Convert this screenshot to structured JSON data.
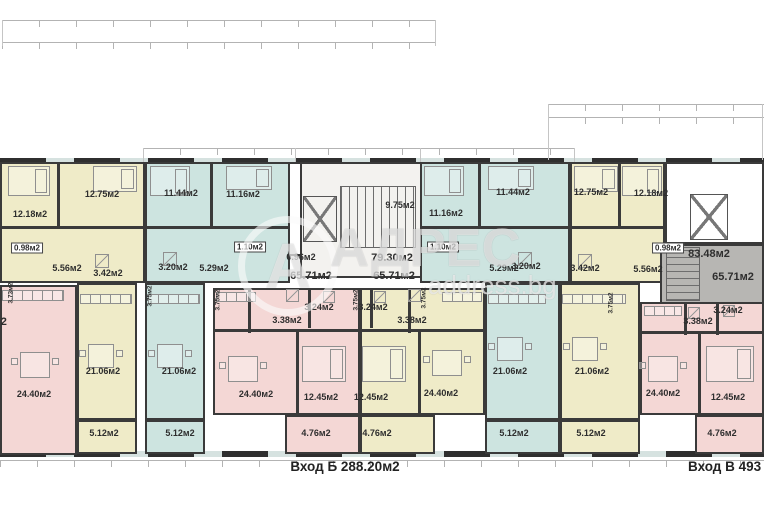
{
  "watermark": {
    "logo_letter": "А",
    "brand": "АДРЕС",
    "site": "address.bg"
  },
  "footer": {
    "entrance_b": "Вход Б 288.20м2",
    "entrance_v": "Вход В 493"
  },
  "colors": {
    "yellow": "#efebc8",
    "blue": "#cde4e0",
    "pink": "#f4d7d5",
    "gray": "#b7b6b3",
    "stair": "#f3f2ef",
    "wall": "#3a3a3a"
  },
  "regions": [
    {
      "name": "unit-yellow-left-top",
      "cls": "yellow",
      "x": 0,
      "y": 162,
      "w": 145,
      "h": 121
    },
    {
      "name": "unit-blue-left-top",
      "cls": "blue",
      "x": 145,
      "y": 162,
      "w": 145,
      "h": 121
    },
    {
      "name": "shaft-left",
      "cls": "white",
      "x": 288,
      "y": 162,
      "w": 24,
      "h": 94
    },
    {
      "name": "stairwell-center",
      "cls": "stair",
      "x": 300,
      "y": 162,
      "w": 172,
      "h": 116
    },
    {
      "name": "unit-blue-right-top",
      "cls": "blue",
      "x": 420,
      "y": 162,
      "w": 150,
      "h": 121
    },
    {
      "name": "unit-yellow-right-top",
      "cls": "yellow",
      "x": 570,
      "y": 162,
      "w": 95,
      "h": 121
    },
    {
      "name": "stair-upper-right",
      "cls": "white",
      "x": 665,
      "y": 162,
      "w": 99,
      "h": 82
    },
    {
      "name": "stairwell-gray-right",
      "cls": "gray",
      "x": 660,
      "y": 244,
      "w": 104,
      "h": 60
    },
    {
      "name": "unit-pink-left",
      "cls": "pink",
      "x": 0,
      "y": 285,
      "w": 77,
      "h": 170
    },
    {
      "name": "living-yellow-left",
      "cls": "yellow",
      "x": 77,
      "y": 283,
      "w": 60,
      "h": 137
    },
    {
      "name": "balcony-yellow-left",
      "cls": "yellow",
      "x": 77,
      "y": 420,
      "w": 60,
      "h": 34
    },
    {
      "name": "living-blue-left",
      "cls": "blue",
      "x": 145,
      "y": 283,
      "w": 60,
      "h": 137
    },
    {
      "name": "balcony-blue-left",
      "cls": "blue",
      "x": 145,
      "y": 420,
      "w": 60,
      "h": 34
    },
    {
      "name": "unit-pink-mid",
      "cls": "pink",
      "x": 213,
      "y": 288,
      "w": 147,
      "h": 127
    },
    {
      "name": "balcony-pink-mid",
      "cls": "pink",
      "x": 285,
      "y": 415,
      "w": 75,
      "h": 39
    },
    {
      "name": "unit-yellow-mid",
      "cls": "yellow",
      "x": 360,
      "y": 288,
      "w": 125,
      "h": 127
    },
    {
      "name": "balcony-yellow-mid",
      "cls": "yellow",
      "x": 360,
      "y": 415,
      "w": 75,
      "h": 39
    },
    {
      "name": "living-blue-right",
      "cls": "blue",
      "x": 485,
      "y": 283,
      "w": 75,
      "h": 137
    },
    {
      "name": "balcony-blue-right",
      "cls": "blue",
      "x": 485,
      "y": 420,
      "w": 75,
      "h": 34
    },
    {
      "name": "living-yellow-right",
      "cls": "yellow",
      "x": 560,
      "y": 283,
      "w": 80,
      "h": 137
    },
    {
      "name": "balcony-yellow-right",
      "cls": "yellow",
      "x": 560,
      "y": 420,
      "w": 80,
      "h": 34
    },
    {
      "name": "unit-pink-right",
      "cls": "pink",
      "x": 640,
      "y": 302,
      "w": 124,
      "h": 113
    },
    {
      "name": "balcony-pink-right",
      "cls": "pink",
      "x": 695,
      "y": 415,
      "w": 69,
      "h": 39
    }
  ],
  "walls": [
    [
      57,
      162,
      3,
      66
    ],
    [
      210,
      162,
      3,
      66
    ],
    [
      478,
      162,
      3,
      66
    ],
    [
      618,
      162,
      3,
      66
    ],
    [
      0,
      226,
      290,
      3
    ],
    [
      420,
      226,
      245,
      3
    ],
    [
      296,
      330,
      3,
      85
    ],
    [
      418,
      330,
      3,
      85
    ],
    [
      698,
      333,
      3,
      82
    ],
    [
      213,
      329,
      147,
      3
    ],
    [
      360,
      329,
      125,
      3
    ],
    [
      640,
      331,
      124,
      3
    ],
    [
      248,
      288,
      3,
      45
    ],
    [
      308,
      288,
      3,
      40
    ],
    [
      370,
      288,
      3,
      40
    ],
    [
      408,
      288,
      3,
      45
    ],
    [
      684,
      302,
      3,
      33
    ],
    [
      716,
      302,
      3,
      33
    ]
  ],
  "furniture": [
    {
      "t": "bed",
      "x": 8,
      "y": 166,
      "w": 42,
      "h": 30
    },
    {
      "t": "bed",
      "x": 93,
      "y": 166,
      "w": 44,
      "h": 26
    },
    {
      "t": "bed",
      "x": 150,
      "y": 166,
      "w": 40,
      "h": 30
    },
    {
      "t": "bed",
      "x": 226,
      "y": 166,
      "w": 46,
      "h": 24
    },
    {
      "t": "bed",
      "x": 424,
      "y": 166,
      "w": 40,
      "h": 30
    },
    {
      "t": "bed",
      "x": 488,
      "y": 166,
      "w": 46,
      "h": 24
    },
    {
      "t": "bed",
      "x": 574,
      "y": 166,
      "w": 44,
      "h": 26
    },
    {
      "t": "bed",
      "x": 622,
      "y": 166,
      "w": 40,
      "h": 30
    },
    {
      "t": "bed",
      "x": 302,
      "y": 346,
      "w": 44,
      "h": 36
    },
    {
      "t": "bed",
      "x": 362,
      "y": 346,
      "w": 44,
      "h": 36
    },
    {
      "t": "bed",
      "x": 706,
      "y": 346,
      "w": 48,
      "h": 36
    },
    {
      "t": "table",
      "x": 20,
      "y": 352,
      "w": 30,
      "h": 26
    },
    {
      "t": "table",
      "x": 88,
      "y": 344,
      "w": 26,
      "h": 24
    },
    {
      "t": "table",
      "x": 157,
      "y": 344,
      "w": 26,
      "h": 24
    },
    {
      "t": "table",
      "x": 228,
      "y": 356,
      "w": 30,
      "h": 26
    },
    {
      "t": "table",
      "x": 432,
      "y": 350,
      "w": 30,
      "h": 26
    },
    {
      "t": "table",
      "x": 497,
      "y": 337,
      "w": 26,
      "h": 24
    },
    {
      "t": "table",
      "x": 572,
      "y": 337,
      "w": 26,
      "h": 24
    },
    {
      "t": "table",
      "x": 648,
      "y": 356,
      "w": 30,
      "h": 26
    },
    {
      "t": "chair",
      "x": 11,
      "y": 358,
      "w": 7,
      "h": 7
    },
    {
      "t": "chair",
      "x": 52,
      "y": 358,
      "w": 7,
      "h": 7
    },
    {
      "t": "chair",
      "x": 79,
      "y": 350,
      "w": 7,
      "h": 7
    },
    {
      "t": "chair",
      "x": 116,
      "y": 350,
      "w": 7,
      "h": 7
    },
    {
      "t": "chair",
      "x": 148,
      "y": 350,
      "w": 7,
      "h": 7
    },
    {
      "t": "chair",
      "x": 185,
      "y": 350,
      "w": 7,
      "h": 7
    },
    {
      "t": "chair",
      "x": 219,
      "y": 362,
      "w": 7,
      "h": 7
    },
    {
      "t": "chair",
      "x": 260,
      "y": 362,
      "w": 7,
      "h": 7
    },
    {
      "t": "chair",
      "x": 423,
      "y": 356,
      "w": 7,
      "h": 7
    },
    {
      "t": "chair",
      "x": 464,
      "y": 356,
      "w": 7,
      "h": 7
    },
    {
      "t": "chair",
      "x": 488,
      "y": 343,
      "w": 7,
      "h": 7
    },
    {
      "t": "chair",
      "x": 525,
      "y": 343,
      "w": 7,
      "h": 7
    },
    {
      "t": "chair",
      "x": 563,
      "y": 343,
      "w": 7,
      "h": 7
    },
    {
      "t": "chair",
      "x": 600,
      "y": 343,
      "w": 7,
      "h": 7
    },
    {
      "t": "chair",
      "x": 639,
      "y": 362,
      "w": 7,
      "h": 7
    },
    {
      "t": "chair",
      "x": 680,
      "y": 362,
      "w": 7,
      "h": 7
    },
    {
      "t": "counter",
      "x": 2,
      "y": 290,
      "w": 62,
      "h": 11
    },
    {
      "t": "counter",
      "x": 80,
      "y": 294,
      "w": 52,
      "h": 10
    },
    {
      "t": "counter",
      "x": 148,
      "y": 294,
      "w": 52,
      "h": 10
    },
    {
      "t": "counter",
      "x": 216,
      "y": 292,
      "w": 40,
      "h": 10
    },
    {
      "t": "counter",
      "x": 442,
      "y": 292,
      "w": 40,
      "h": 10
    },
    {
      "t": "counter",
      "x": 488,
      "y": 294,
      "w": 58,
      "h": 10
    },
    {
      "t": "counter",
      "x": 562,
      "y": 294,
      "w": 64,
      "h": 10
    },
    {
      "t": "counter",
      "x": 644,
      "y": 306,
      "w": 38,
      "h": 10
    },
    {
      "t": "shower",
      "x": 95,
      "y": 254,
      "w": 14,
      "h": 14
    },
    {
      "t": "shower",
      "x": 163,
      "y": 252,
      "w": 14,
      "h": 14
    },
    {
      "t": "shower",
      "x": 286,
      "y": 289,
      "w": 13,
      "h": 13
    },
    {
      "t": "shower",
      "x": 323,
      "y": 291,
      "w": 12,
      "h": 12
    },
    {
      "t": "shower",
      "x": 374,
      "y": 291,
      "w": 12,
      "h": 12
    },
    {
      "t": "shower",
      "x": 408,
      "y": 289,
      "w": 13,
      "h": 13
    },
    {
      "t": "shower",
      "x": 518,
      "y": 252,
      "w": 14,
      "h": 14
    },
    {
      "t": "shower",
      "x": 578,
      "y": 254,
      "w": 14,
      "h": 14
    },
    {
      "t": "shower",
      "x": 688,
      "y": 307,
      "w": 12,
      "h": 12
    },
    {
      "t": "shower",
      "x": 723,
      "y": 305,
      "w": 12,
      "h": 12
    },
    {
      "t": "stairs",
      "x": 340,
      "y": 186,
      "w": 76,
      "h": 62
    },
    {
      "t": "stairsv",
      "x": 666,
      "y": 247,
      "w": 34,
      "h": 54
    },
    {
      "t": "elev",
      "x": 303,
      "y": 196,
      "w": 34,
      "h": 46
    },
    {
      "t": "elev",
      "x": 690,
      "y": 194,
      "w": 38,
      "h": 46
    }
  ],
  "labels": [
    {
      "t": "12.18м2",
      "x": 30,
      "y": 214,
      "k": ""
    },
    {
      "t": "12.75м2",
      "x": 102,
      "y": 194,
      "k": ""
    },
    {
      "t": "5.56м2",
      "x": 67,
      "y": 268,
      "k": ""
    },
    {
      "t": "3.42м2",
      "x": 108,
      "y": 273,
      "k": ""
    },
    {
      "t": "21.06м2",
      "x": 103,
      "y": 371,
      "k": ""
    },
    {
      "t": "5.12м2",
      "x": 104,
      "y": 433,
      "k": ""
    },
    {
      "t": "24.40м2",
      "x": 34,
      "y": 394,
      "k": ""
    },
    {
      "t": "11.44м2",
      "x": 181,
      "y": 193,
      "k": ""
    },
    {
      "t": "11.16м2",
      "x": 243,
      "y": 194,
      "k": ""
    },
    {
      "t": "3.20м2",
      "x": 173,
      "y": 267,
      "k": ""
    },
    {
      "t": "5.29м2",
      "x": 214,
      "y": 268,
      "k": ""
    },
    {
      "t": "21.06м2",
      "x": 179,
      "y": 371,
      "k": ""
    },
    {
      "t": "5.12м2",
      "x": 180,
      "y": 433,
      "k": ""
    },
    {
      "t": "3.38м2",
      "x": 287,
      "y": 320,
      "k": ""
    },
    {
      "t": "3.24м2",
      "x": 319,
      "y": 307,
      "k": ""
    },
    {
      "t": "24.40м2",
      "x": 256,
      "y": 394,
      "k": ""
    },
    {
      "t": "12.45м2",
      "x": 321,
      "y": 397,
      "k": ""
    },
    {
      "t": "4.76м2",
      "x": 316,
      "y": 433,
      "k": ""
    },
    {
      "t": "9.75м2",
      "x": 400,
      "y": 205,
      "k": ""
    },
    {
      "t": "0.96м2",
      "x": 301,
      "y": 257,
      "k": ""
    },
    {
      "t": "3.24м2",
      "x": 373,
      "y": 307,
      "k": ""
    },
    {
      "t": "3.38м2",
      "x": 412,
      "y": 320,
      "k": ""
    },
    {
      "t": "12.45м2",
      "x": 371,
      "y": 397,
      "k": ""
    },
    {
      "t": "24.40м2",
      "x": 441,
      "y": 393,
      "k": ""
    },
    {
      "t": "4.76м2",
      "x": 377,
      "y": 433,
      "k": ""
    },
    {
      "t": "11.16м2",
      "x": 446,
      "y": 213,
      "k": ""
    },
    {
      "t": "11.44м2",
      "x": 513,
      "y": 192,
      "k": ""
    },
    {
      "t": "5.29м2",
      "x": 504,
      "y": 268,
      "k": ""
    },
    {
      "t": "3.20м2",
      "x": 526,
      "y": 266,
      "k": ""
    },
    {
      "t": "21.06м2",
      "x": 510,
      "y": 371,
      "k": ""
    },
    {
      "t": "5.12м2",
      "x": 514,
      "y": 433,
      "k": ""
    },
    {
      "t": "12.75м2",
      "x": 591,
      "y": 192,
      "k": ""
    },
    {
      "t": "12.18м2",
      "x": 651,
      "y": 193,
      "k": ""
    },
    {
      "t": "3.42м2",
      "x": 585,
      "y": 268,
      "k": ""
    },
    {
      "t": "5.56м2",
      "x": 648,
      "y": 269,
      "k": ""
    },
    {
      "t": "21.06м2",
      "x": 592,
      "y": 371,
      "k": ""
    },
    {
      "t": "5.12м2",
      "x": 591,
      "y": 433,
      "k": ""
    },
    {
      "t": "3.38м2",
      "x": 698,
      "y": 321,
      "k": ""
    },
    {
      "t": "3.24м2",
      "x": 728,
      "y": 310,
      "k": ""
    },
    {
      "t": "24.40м2",
      "x": 663,
      "y": 393,
      "k": ""
    },
    {
      "t": "12.45м2",
      "x": 728,
      "y": 397,
      "k": ""
    },
    {
      "t": "4.76м2",
      "x": 722,
      "y": 433,
      "k": ""
    },
    {
      "t": "0.98м2",
      "x": 27,
      "y": 248,
      "k": "box"
    },
    {
      "t": "1.10м2",
      "x": 250,
      "y": 247,
      "k": "box"
    },
    {
      "t": "1.10м2",
      "x": 443,
      "y": 247,
      "k": "box"
    },
    {
      "t": "0.98м2",
      "x": 668,
      "y": 248,
      "k": "box"
    },
    {
      "t": "65.71м2",
      "x": 311,
      "y": 276,
      "k": "big"
    },
    {
      "t": "65.71м2",
      "x": 394,
      "y": 276,
      "k": "big"
    },
    {
      "t": "65.71м2",
      "x": 733,
      "y": 277,
      "k": "big"
    },
    {
      "t": "79.30м2",
      "x": 392,
      "y": 258,
      "k": "big"
    },
    {
      "t": "83.48м2",
      "x": 709,
      "y": 254,
      "k": "big"
    },
    {
      "t": "65.71м2",
      "x": -14,
      "y": 322,
      "k": "big"
    },
    {
      "t": "3.73м2",
      "x": 11,
      "y": 293,
      "k": "rot"
    },
    {
      "t": "3.75м2",
      "x": 150,
      "y": 296,
      "k": "rot"
    },
    {
      "t": "3.75м2",
      "x": 218,
      "y": 300,
      "k": "rot"
    },
    {
      "t": "3.75м2",
      "x": 356,
      "y": 300,
      "k": "rot"
    },
    {
      "t": "3.75м2",
      "x": 424,
      "y": 298,
      "k": "rot"
    },
    {
      "t": "3.75м2",
      "x": 611,
      "y": 303,
      "k": "rot"
    }
  ],
  "dims": {
    "h": [
      [
        2,
        20,
        434
      ],
      [
        2,
        42,
        434
      ],
      [
        548,
        104,
        216
      ],
      [
        548,
        117,
        216
      ],
      [
        143,
        148,
        432
      ],
      [
        0,
        460,
        764
      ]
    ],
    "v": [
      [
        2,
        20,
        26
      ],
      [
        435,
        20,
        26
      ],
      [
        548,
        104,
        56
      ],
      [
        762,
        104,
        56
      ],
      [
        143,
        148,
        14
      ],
      [
        295,
        148,
        14
      ],
      [
        420,
        148,
        14
      ],
      [
        574,
        148,
        14
      ]
    ]
  }
}
